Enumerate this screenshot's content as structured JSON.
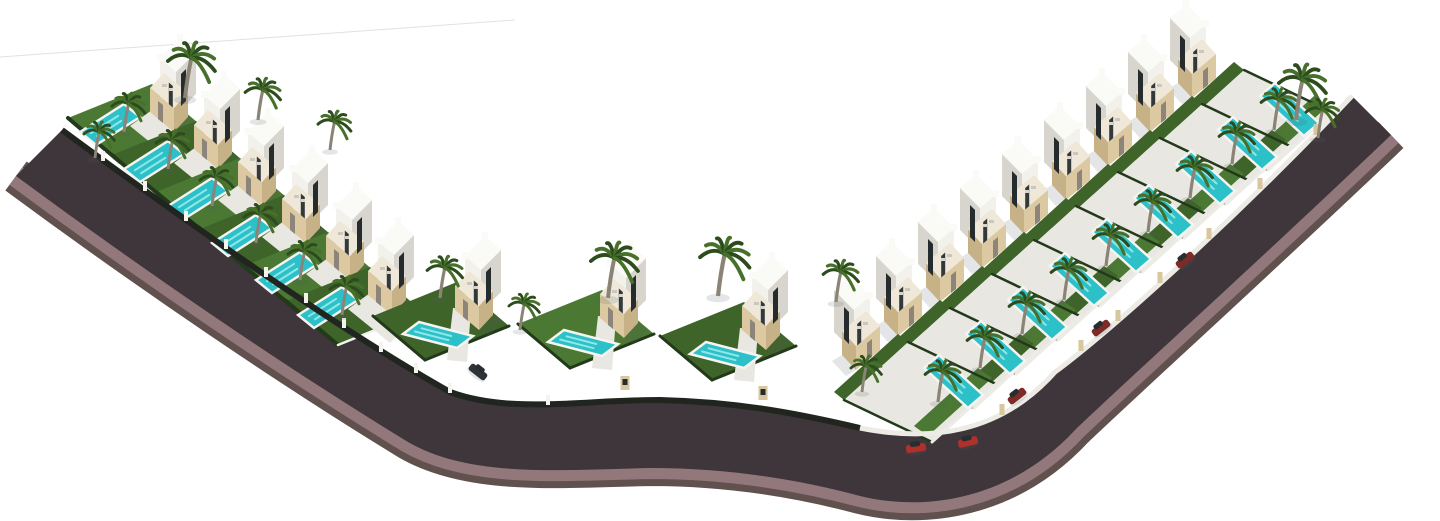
{
  "scene": {
    "alt": "Aerial 3D architectural rendering of a gated residential development: two rows of modern white villas with beige stone facades, private turquoise swimming pools, palm trees and parked cars, arranged along a curved dark asphalt road shaped like a check mark on a white background",
    "villas_total": 18,
    "villas_left_row": 6,
    "villas_center_row": 3,
    "villas_right_row": 9,
    "pools": 18,
    "palm_trees": 27,
    "cars": {
      "red": 2,
      "dark_red": 3,
      "dark": 1
    },
    "street_furniture": {
      "white_fence_pillars": 11,
      "beige_wall_pillars": 7,
      "entrance_gate_pillars": 2
    }
  },
  "colors": {
    "background": "#ffffff",
    "horizon_line": "#c4c4c4",
    "road_asphalt": "#3e363b",
    "road_sidewalk": "#92787a",
    "road_outer_rim": "#60504e",
    "road_curb": "#d8d5d0",
    "fence_dark": "#20261f",
    "wall_white_street": "#edebe5",
    "pillar_white": "#f4f3ee",
    "pillar_beige": "#d7c69e",
    "paving": "#e9e7e1",
    "lawn": "#4b7832",
    "lawn_dark": "#3e6429",
    "hedge": "#223a1b",
    "pool_water": "#2cc0c9",
    "pool_streak": "#8fe7e7",
    "pool_rim": "#f5f4f0",
    "villa_wall_lit": "#f2f1ec",
    "villa_wall_shade": "#d7d5cd",
    "villa_roof": "#fafaf7",
    "stone_lit": "#dcc9a1",
    "stone_shade": "#c7b287",
    "stone_top": "#efe8d8",
    "glass_dark": "#262c2e",
    "glass_mid": "#33393b",
    "door": "#8d857a",
    "palm_frond_dark": "#2d4c1e",
    "palm_frond_light": "#47702b",
    "palm_trunk": "#8b8476",
    "car_red": "#b0302b",
    "car_dark_red": "#7e2a26",
    "car_dark": "#2e3338",
    "shadow": "rgba(90,95,100,0.16)"
  }
}
